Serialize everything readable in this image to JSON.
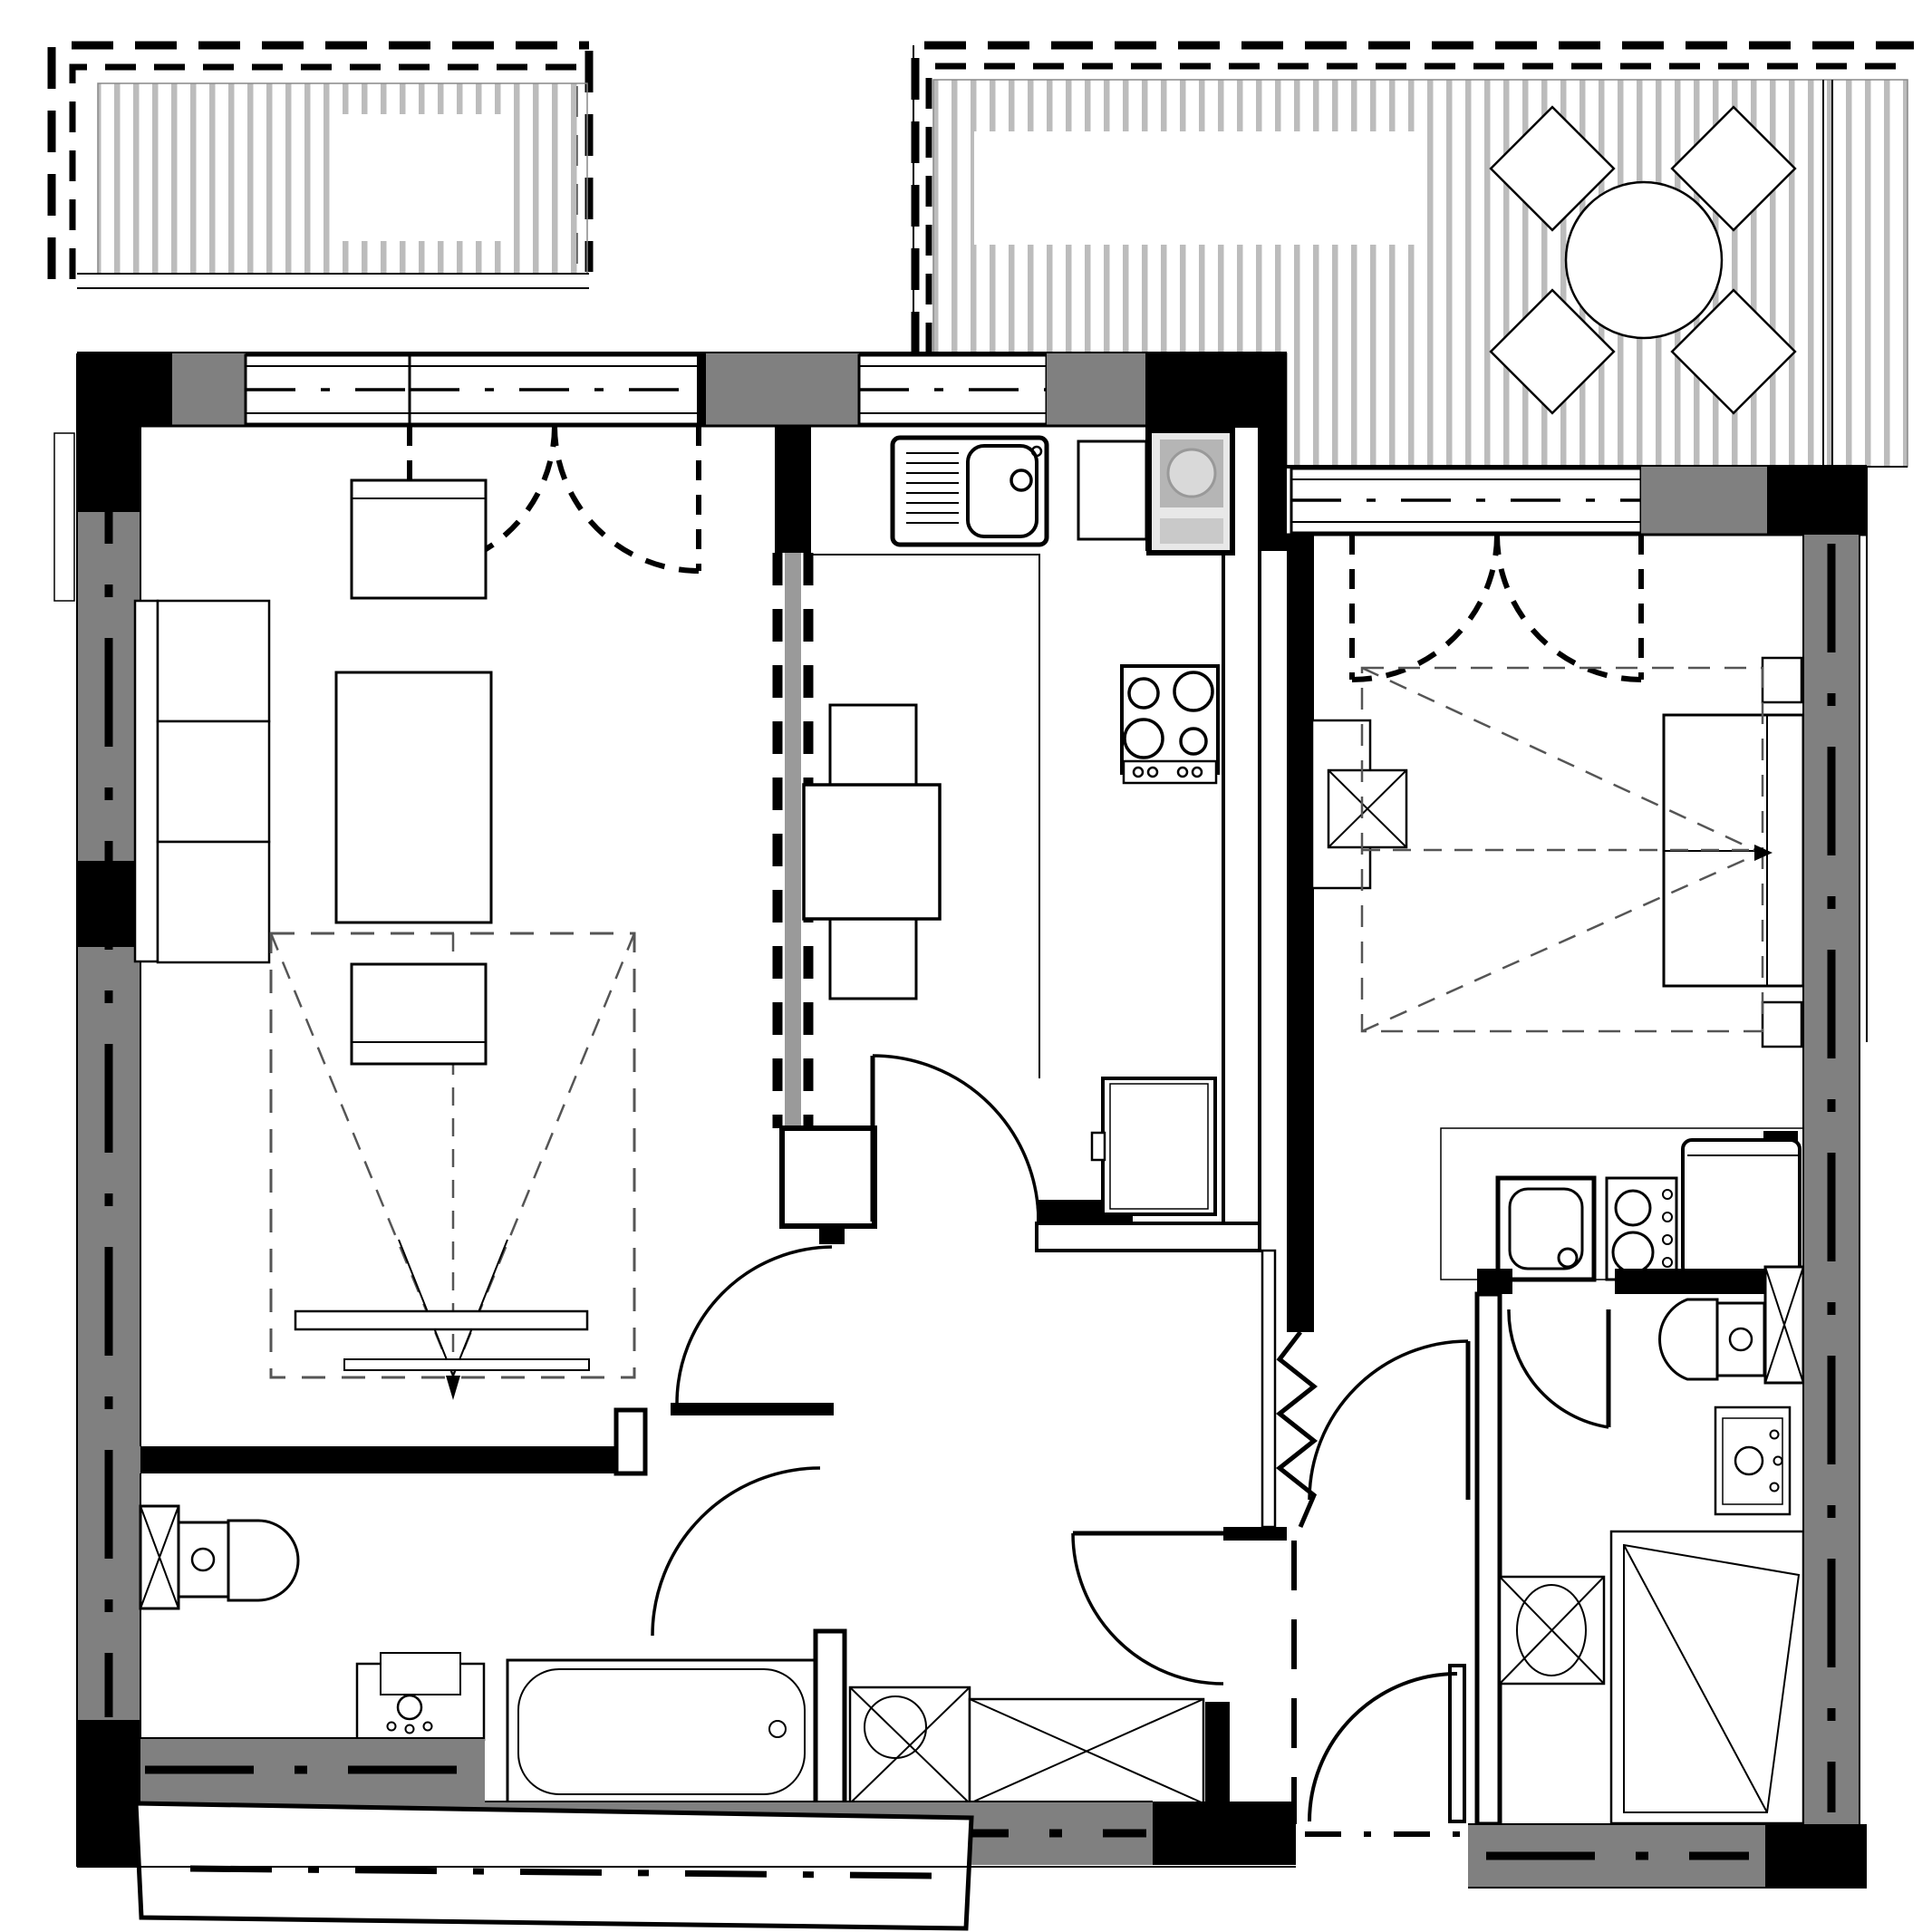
{
  "document": {
    "type": "architectural-floor-plan",
    "description": "Black and white apartment floor plan, two units with terraces, no text labels",
    "text_labels": []
  },
  "colors": {
    "paper": "#ffffff",
    "wall_fill": "#808080",
    "wall_dark": "#000000",
    "decking_stripe": "#bcbcbc",
    "partition_core": "#9a9a9a",
    "appliance_gray": "#b5b5b5",
    "appliance_light": "#d9d9d9",
    "dash_zone": "#555555"
  },
  "rooms": [
    {
      "name": "terrace-left",
      "fixtures": [
        "decking-boards",
        "dashed-roof-overhang"
      ]
    },
    {
      "name": "living-room",
      "fixtures": [
        "sofa-3-seat",
        "coffee-table",
        "armchair",
        "ottoman",
        "tv-bench",
        "projection-zone",
        "french-balcony-door"
      ]
    },
    {
      "name": "kitchen",
      "fixtures": [
        "sink-with-drainboard",
        "dishwasher",
        "washing-machine",
        "hob-4-burner",
        "dining-table",
        "two-chairs",
        "fridge",
        "counter",
        "glazed-partition"
      ]
    },
    {
      "name": "hallway",
      "fixtures": [
        "wardrobe",
        "shower",
        "interior-doors"
      ]
    },
    {
      "name": "bathroom-1",
      "fixtures": [
        "toilet",
        "washbasin",
        "bathtub",
        "service-duct"
      ]
    },
    {
      "name": "terrace-right",
      "fixtures": [
        "decking-boards",
        "round-table",
        "four-chairs",
        "dashed-roof-overhang"
      ]
    },
    {
      "name": "studio-room",
      "fixtures": [
        "double-bed",
        "bedside-table",
        "bedside-table",
        "desk",
        "desk-chair",
        "wardrobe-zone-dashed",
        "kitchenette-sink",
        "kitchenette-hob",
        "fridge",
        "french-terrace-door"
      ]
    },
    {
      "name": "bathroom-2",
      "fixtures": [
        "toilet",
        "washbasin",
        "washing-machine",
        "shower",
        "service-duct"
      ]
    },
    {
      "name": "entry",
      "fixtures": [
        "entrance-door",
        "threshold",
        "outdoor-landing"
      ]
    }
  ]
}
